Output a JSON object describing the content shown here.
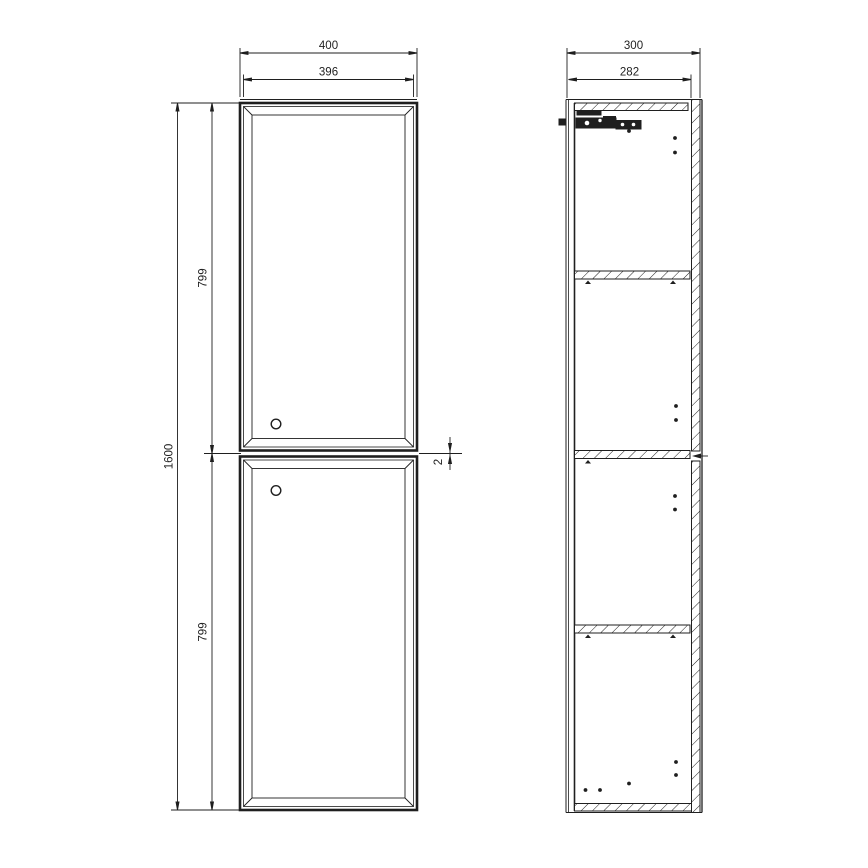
{
  "drawing": {
    "subject": "tall-cabinet-orthographic-drawing",
    "units": "mm",
    "front_view": {
      "dims": {
        "overall_width": "400",
        "door_width": "396",
        "overall_height": "1600",
        "upper_door_height": "799",
        "lower_door_height": "799",
        "door_gap": "2"
      },
      "features": {
        "doors": 2,
        "handle_holes": 2
      }
    },
    "side_view": {
      "dims": {
        "overall_depth": "300",
        "inner_depth": "282"
      },
      "features": {
        "shelves": 3,
        "top_panel": 1,
        "bottom_panel": 1,
        "wall_bracket": 1,
        "drill_holes": 12
      }
    },
    "colors": {
      "line": "#1f1f1f",
      "background": "#ffffff"
    }
  }
}
